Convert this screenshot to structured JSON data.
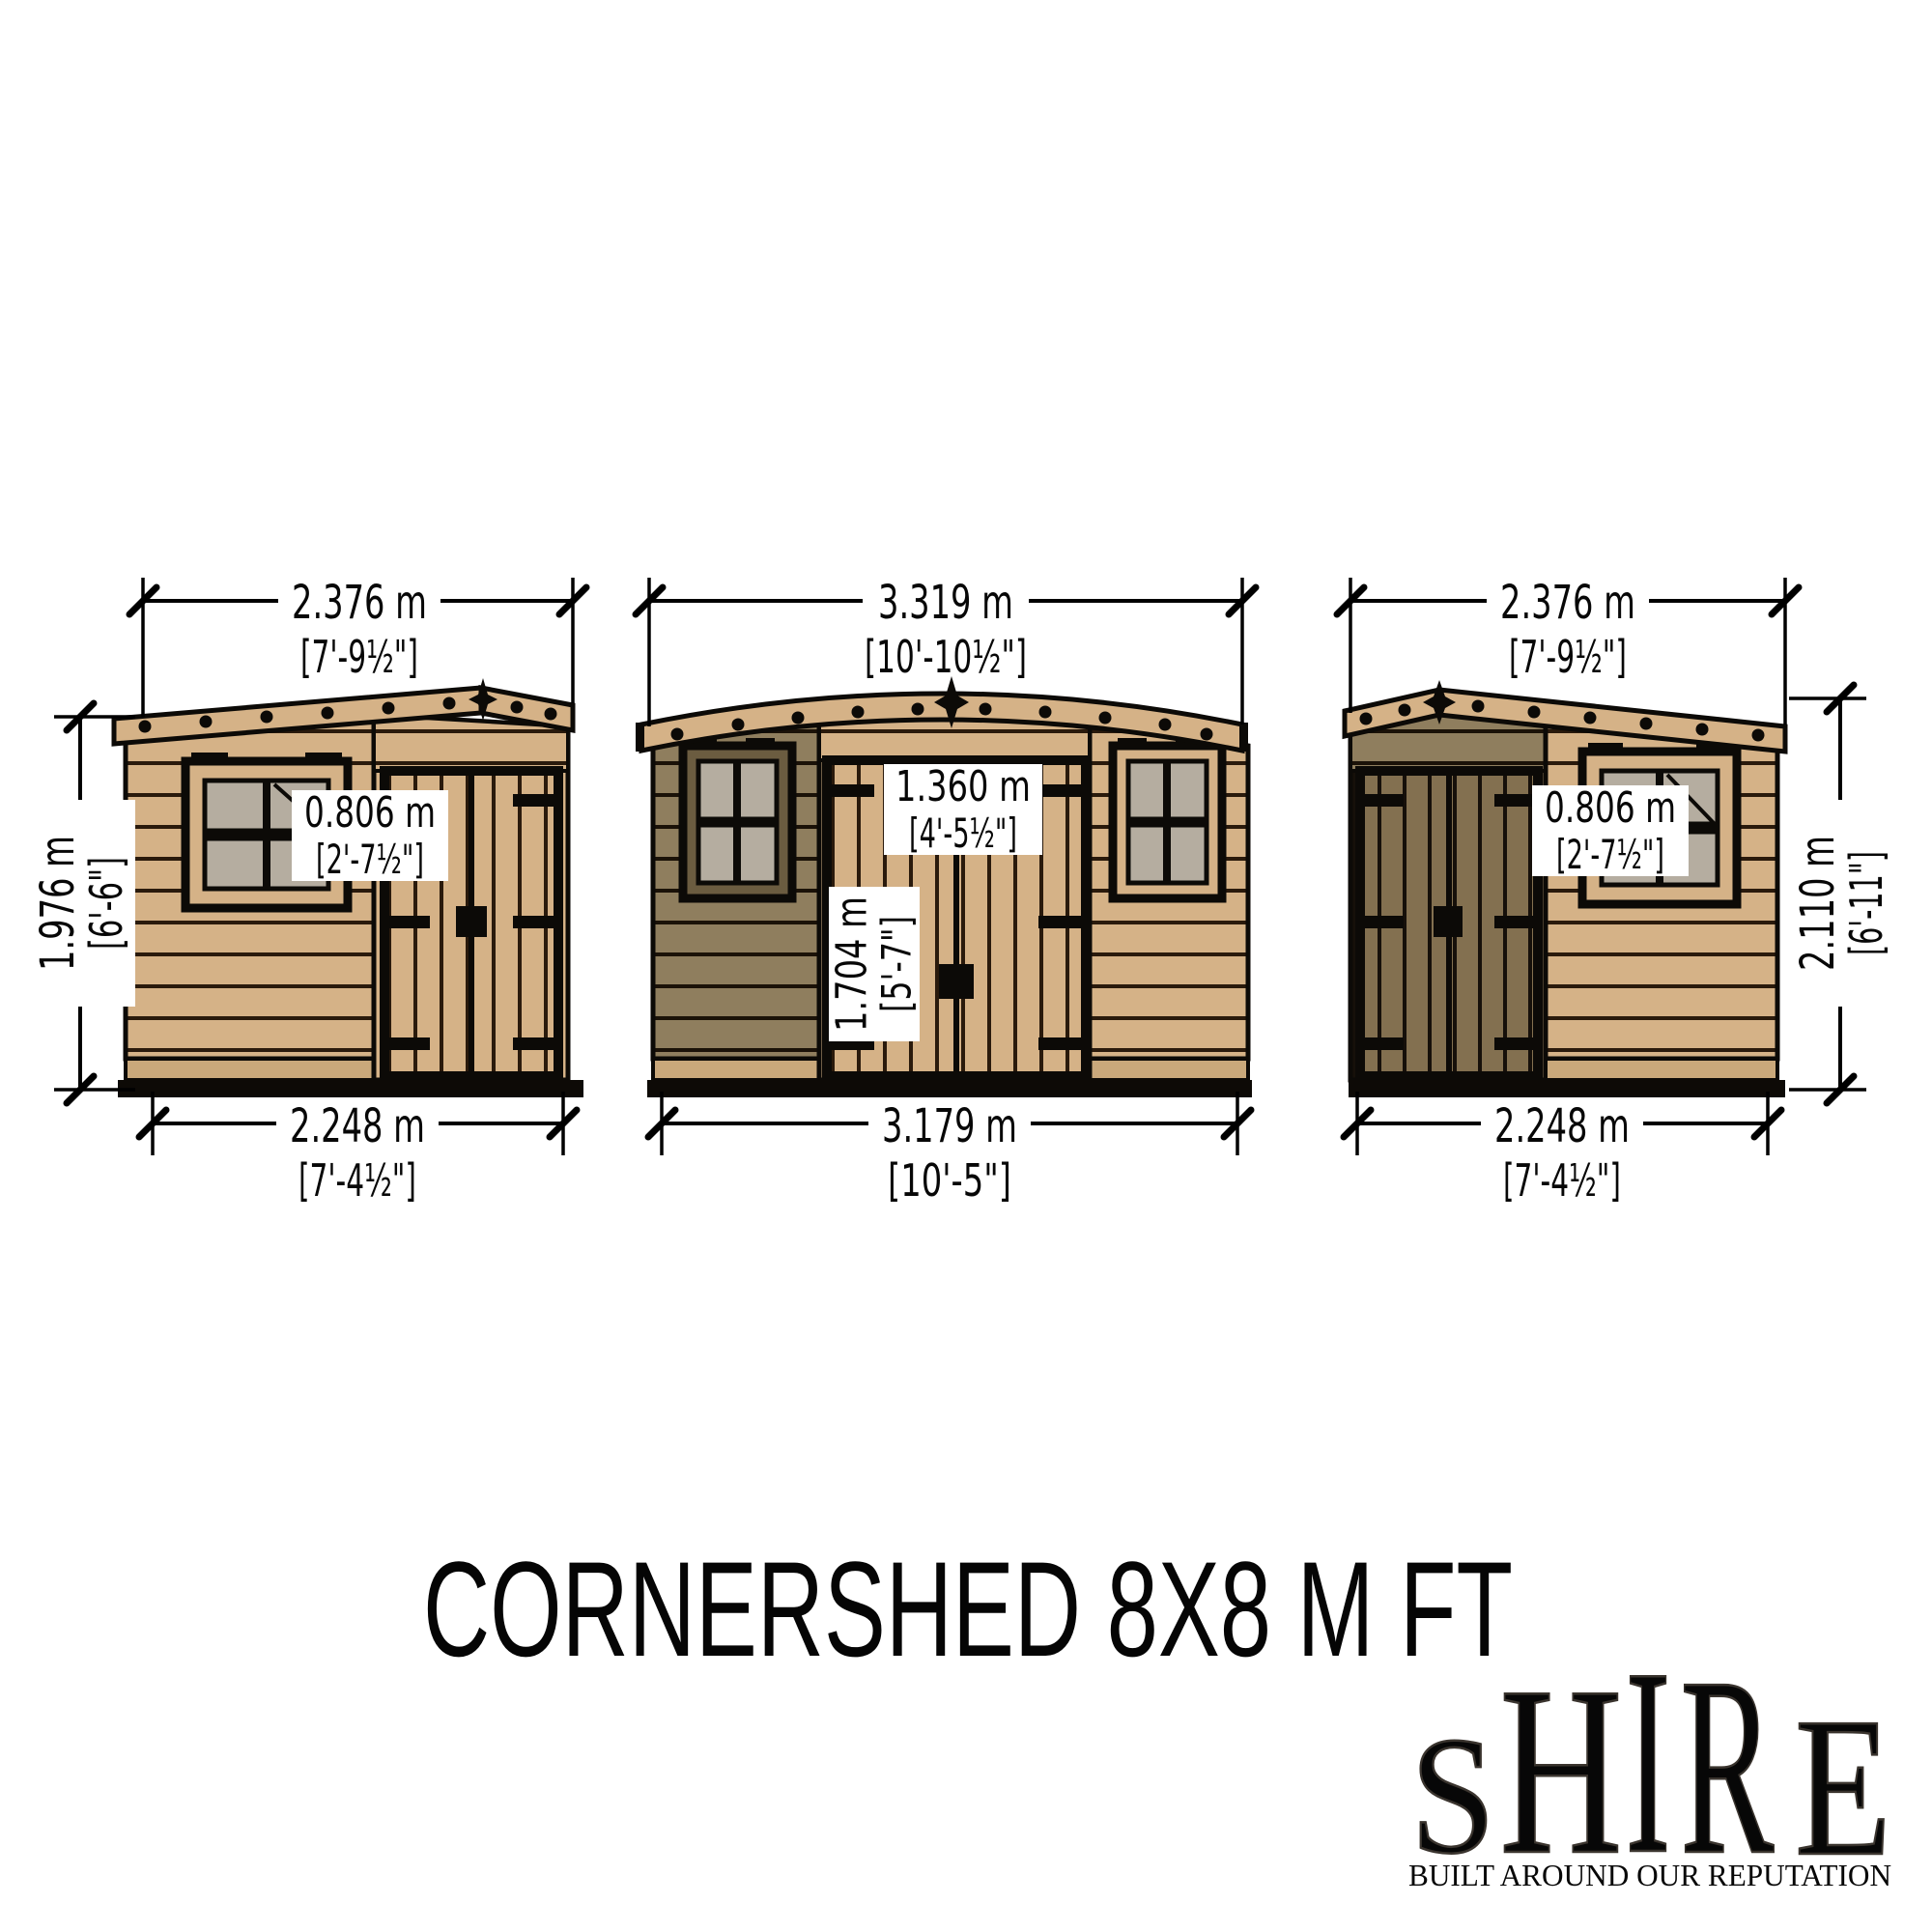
{
  "title": "CORNERSHED 8X8 M FT",
  "views": {
    "left": {
      "top_m": "2.376 m",
      "top_ft": "[7'-9½\"]",
      "height_m": "1.976 m",
      "height_ft": "[6'-6\"]",
      "window_m": "0.806 m",
      "window_ft": "[2'-7½\"]",
      "base_m": "2.248 m",
      "base_ft": "[7'-4½\"]"
    },
    "front": {
      "top_m": "3.319 m",
      "top_ft": "[10'-10½\"]",
      "door_width_m": "1.360 m",
      "door_width_ft": "[4'-5½\"]",
      "door_height_m": "1.704 m",
      "door_height_ft": "[5'-7\"]",
      "base_m": "3.179 m",
      "base_ft": "[10'-5\"]"
    },
    "right": {
      "top_m": "2.376 m",
      "top_ft": "[7'-9½\"]",
      "height_m": "2.110 m",
      "height_ft": "[6'-11\"]",
      "window_m": "0.806 m",
      "window_ft": "[2'-7½\"]",
      "base_m": "2.248 m",
      "base_ft": "[7'-4½\"]"
    }
  },
  "logo": {
    "letters": [
      "S",
      "H",
      "I",
      "R",
      "E"
    ],
    "tagline": "BUILT AROUND OUR REPUTATION"
  },
  "colors": {
    "wood_light": "#d5b287",
    "wood_dark": "#8f7e5e",
    "wood_door_dark": "#837050",
    "glass": "#b5ada0",
    "line": "#000000",
    "flag_red": "#c8102e",
    "flag_blue": "#1f3868"
  }
}
